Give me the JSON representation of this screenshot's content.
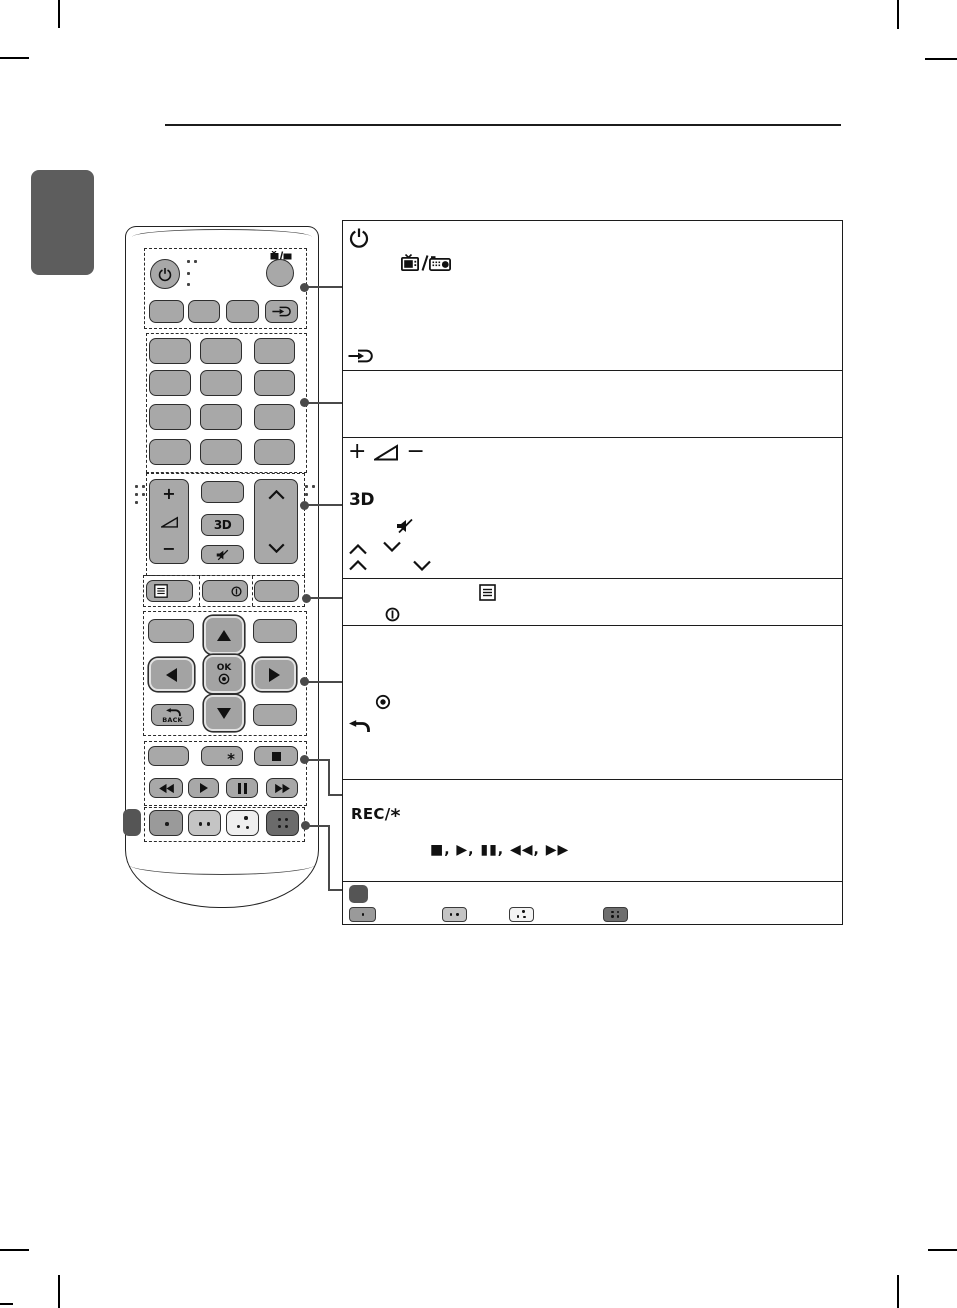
{
  "page": {
    "kind": "remote-control-description-page",
    "section_tab_color": "#5d5d5d",
    "line_color": "#1c1c1c"
  },
  "remote": {
    "labels": {
      "threed": "3D",
      "ok": "OK",
      "back": "BACK",
      "vol_plus": "+",
      "vol_minus": "−"
    },
    "icons": [
      "power-icon",
      "tv-radio-icon",
      "input-icon",
      "volume-wedge-icon",
      "3d-icon",
      "mute-icon",
      "chevron-up-icon",
      "chevron-down-icon",
      "menu-icon",
      "info-icon",
      "up-arrow-icon",
      "down-arrow-icon",
      "left-arrow-icon",
      "right-arrow-icon",
      "ok-target-icon",
      "back-arrow-icon",
      "rec-asterisk-icon",
      "stop-icon",
      "rewind-icon",
      "play-icon",
      "pause-icon",
      "fast-forward-icon",
      "one-dot-button-icon",
      "two-dot-button-icon",
      "three-dot-button-icon",
      "four-dot-button-icon",
      "side-button-icon"
    ]
  },
  "table": {
    "rows": [
      {
        "id": "power-tvrad-input",
        "icons": [
          "power-icon",
          "tv-radio-icon",
          "input-icon"
        ]
      },
      {
        "id": "number-buttons",
        "icons": []
      },
      {
        "id": "volume-3d-mute-channel",
        "vol_plus": "+",
        "vol_minus": "−",
        "threed_label": "3D",
        "icons": [
          "volume-plus-icon",
          "volume-wedge-icon",
          "volume-minus-icon",
          "3d-icon",
          "mute-icon",
          "chevron-up-icon",
          "chevron-down-icon",
          "chevron-up-icon",
          "chevron-down-icon"
        ]
      },
      {
        "id": "menu-info",
        "icons": [
          "menu-icon",
          "info-icon"
        ]
      },
      {
        "id": "ok-back",
        "icons": [
          "ok-target-icon",
          "back-arrow-icon"
        ]
      },
      {
        "id": "rec-playback",
        "rec_label": "REC/",
        "rec_symbol": "*",
        "playback_sequence": "■, ▶, ▮▮, ◀◀, ▶▶",
        "icons": [
          "stop-icon",
          "play-icon",
          "pause-icon",
          "rewind-icon",
          "fast-forward-icon"
        ]
      },
      {
        "id": "color-buttons",
        "icons": [
          "side-button-icon",
          "one-dot-button-icon",
          "two-dot-button-icon",
          "three-dot-button-icon",
          "four-dot-button-icon"
        ]
      }
    ]
  }
}
